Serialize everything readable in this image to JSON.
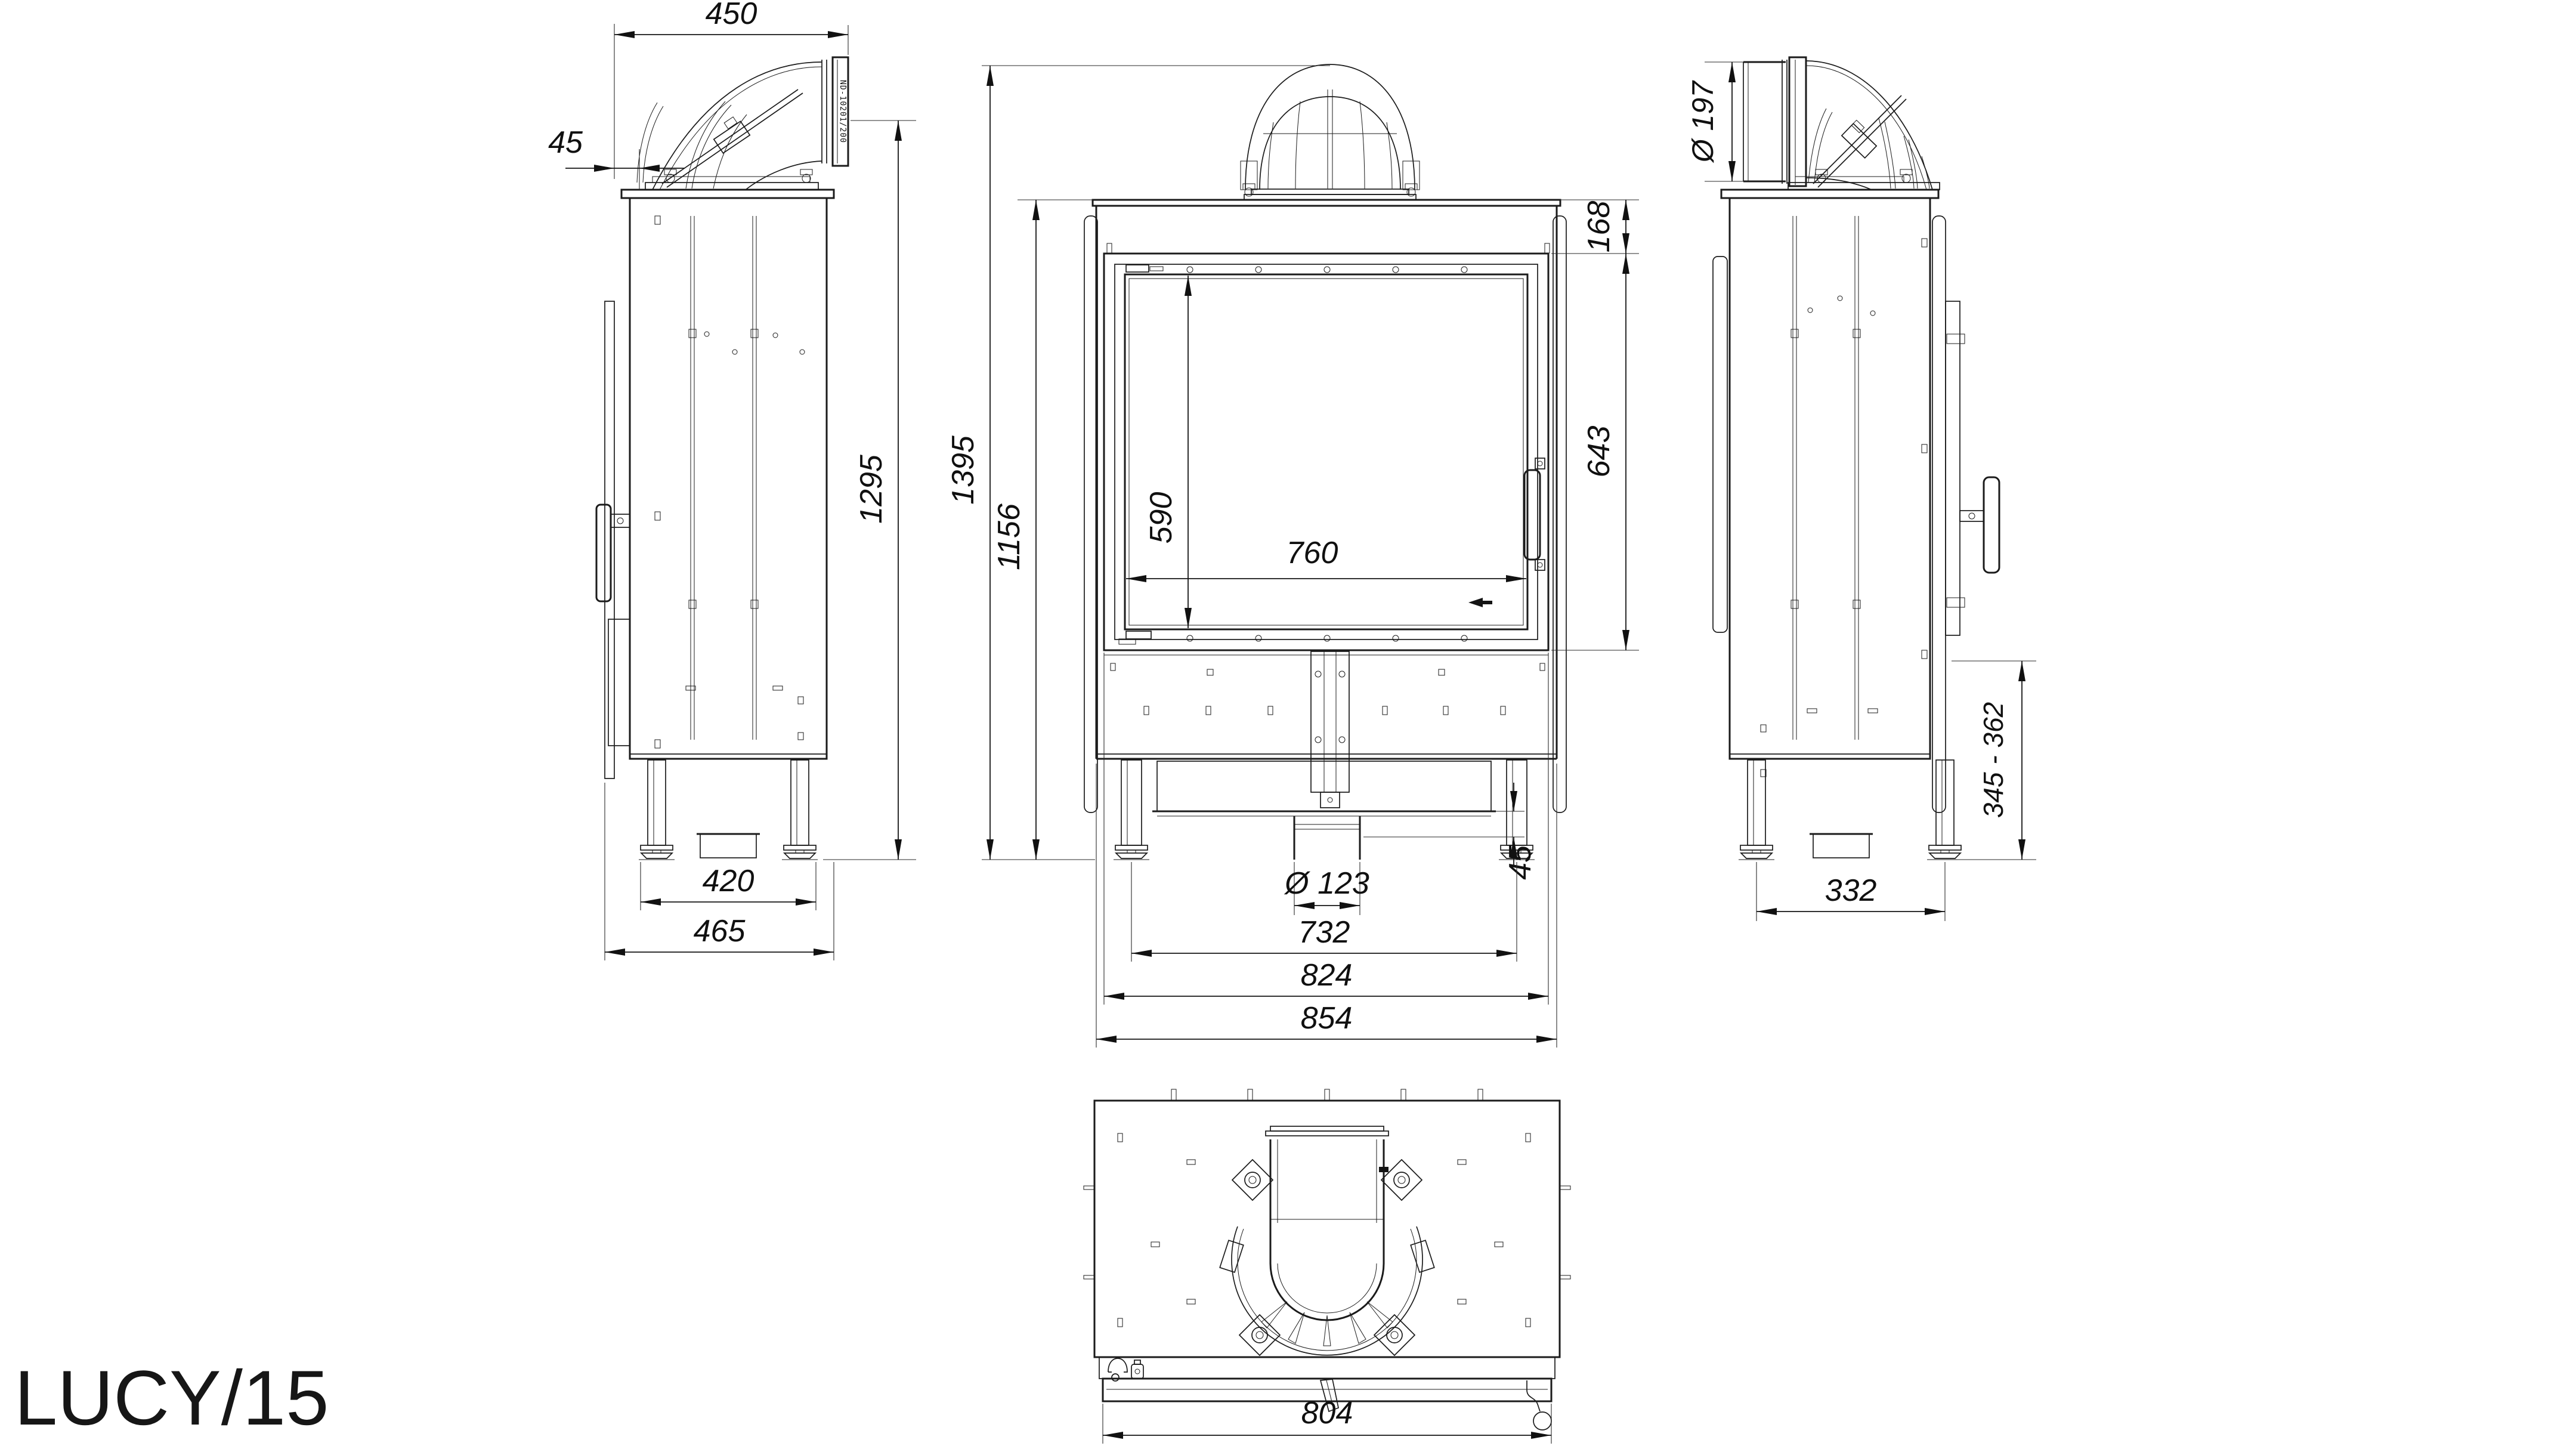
{
  "title": "LUCY/15",
  "drawing": {
    "left_view": {
      "dim_top_width": "450",
      "dim_flue_offset": "45",
      "dim_height": "1295",
      "dim_feet_spacing": "420",
      "dim_depth": "465",
      "flue_marking": "ND-10201/200"
    },
    "front_view": {
      "dim_total_height": "1395",
      "dim_body_height": "1156",
      "dim_top_inset": "168",
      "dim_door_height": "643",
      "dim_glass_height": "590",
      "dim_glass_width": "760",
      "dim_duct_inset": "45",
      "dim_duct_diameter": "Ø 123",
      "dim_feet_spacing": "732",
      "dim_frame_width": "824",
      "dim_total_width": "854"
    },
    "right_view": {
      "dim_flue_diameter": "Ø 197",
      "dim_mount_height": "345 - 362",
      "dim_feet_spacing": "332"
    },
    "bottom_view": {
      "dim_width": "804"
    }
  }
}
